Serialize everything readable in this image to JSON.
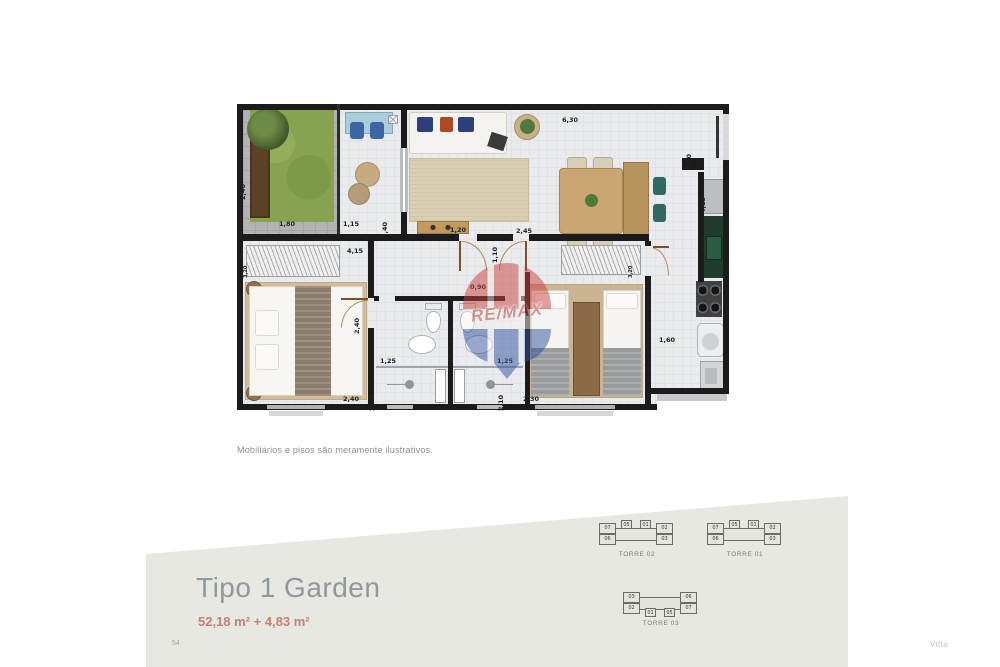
{
  "plan": {
    "caption": "Mobiliários e pisos são meramente ilustrativos.",
    "watermark": "RE/MAX",
    "dims": {
      "garden_width": "1,80",
      "garden_depth": "2,40",
      "terrace_width": "1,15",
      "terrace_depth": "2,40",
      "living_depth": "2,40",
      "sideboard_width": "1,20",
      "living_width": "2,45",
      "top_width": "6,30",
      "entry_width": "1,10",
      "kitchen_depth": "4,15",
      "kitchen_width": "1,60",
      "bedroom1_width": "4,15",
      "bedroom1_bottom": "2,40",
      "bedroom1_depth": "2,40",
      "hall_width": "0,90",
      "hall_depth": "1,10",
      "bath1_width": "1,25",
      "bath1_depth": "2,10",
      "bath2_width": "1,25",
      "bath2_depth": "2,10",
      "bedroom2_width": "2,30",
      "wardrobe1": "3,20",
      "wardrobe2": "3,20"
    }
  },
  "band": {
    "title": "Tipo 1 Garden",
    "area": "52,18 m² + 4,83 m²"
  },
  "towers": [
    {
      "label": "TORRE 02",
      "units": [
        "07",
        "06",
        "05",
        "01",
        "02",
        "03"
      ]
    },
    {
      "label": "TORRE 01",
      "units": [
        "07",
        "06",
        "05",
        "01",
        "02",
        "03"
      ]
    },
    {
      "label": "TORRE 03",
      "units": [
        "03",
        "02",
        "01",
        "05",
        "06",
        "07"
      ]
    }
  ],
  "footer": {
    "page": "54",
    "brand": "Vitta"
  },
  "colors": {
    "wall": "#1b1b1b",
    "band_bg": "#e8e8e3",
    "title": "#8e989d",
    "area": "#c5806e",
    "remax_red": "#c8423c",
    "remax_blue": "#31519e",
    "grass": "#87a351",
    "counter_green": "#1f3c2d"
  }
}
